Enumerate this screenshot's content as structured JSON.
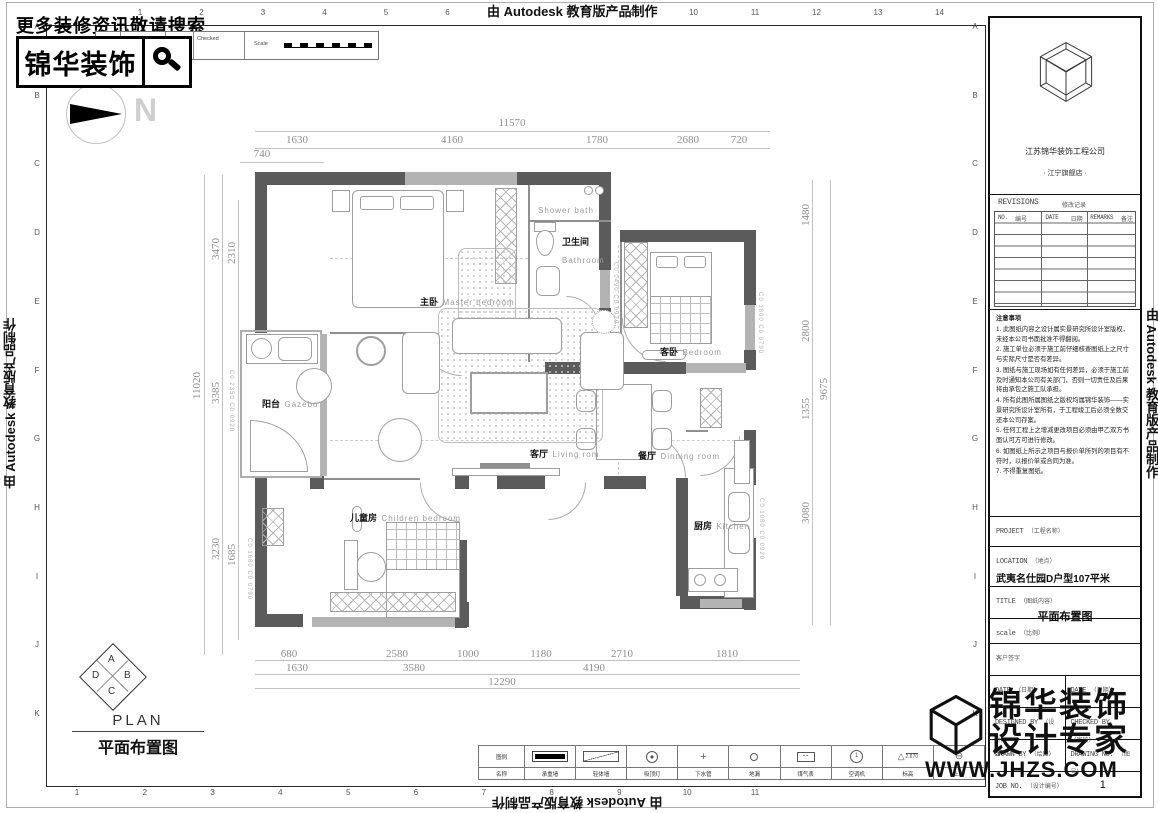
{
  "watermarks": {
    "autodesk": "由 Autodesk 教育版产品制作",
    "jhzs_line1": "锦华装饰",
    "jhzs_line2": "设计专家",
    "jhzs_url": "WWW.JHZS.COM"
  },
  "header": {
    "search_tip": "更多装修资讯敬请搜索",
    "brand": "锦华装饰",
    "north_label": "N",
    "rev_table": {
      "rev_no": "Rev/No",
      "revision_note": "Revision note",
      "signature": "Signature",
      "checked": "Checked",
      "scale_label": "Scale"
    }
  },
  "grid": {
    "top": [
      "1",
      "2",
      "3",
      "4",
      "5",
      "6",
      "7",
      "8",
      "9",
      "10",
      "11",
      "12",
      "13",
      "14"
    ],
    "bottom": [
      "1",
      "2",
      "3",
      "4",
      "5",
      "6",
      "7",
      "8",
      "9",
      "10",
      "11"
    ],
    "left": [
      "A",
      "B",
      "C",
      "D",
      "E",
      "F",
      "G",
      "H",
      "I",
      "J",
      "K"
    ],
    "right": [
      "A",
      "B",
      "C",
      "D",
      "E",
      "F",
      "G",
      "H",
      "I",
      "J",
      "K"
    ]
  },
  "plan": {
    "rooms": [
      {
        "cn": "主卧",
        "en": "Master bedroom"
      },
      {
        "cn": "",
        "en": "Shower bath"
      },
      {
        "cn": "卫生间",
        "en": "Bathroom"
      },
      {
        "cn": "客卧",
        "en": "Bedroom"
      },
      {
        "cn": "阳台",
        "en": "Gazebo"
      },
      {
        "cn": "客厅",
        "en": "Living rom"
      },
      {
        "cn": "餐厅",
        "en": "Dinning room"
      },
      {
        "cn": "儿童房",
        "en": "Children bedroom"
      },
      {
        "cn": "厨房",
        "en": "Kitchen"
      }
    ],
    "window_tags": [
      "C0 0490 C0 0920",
      "C0 1800 C0 0790",
      "C0 2350 C0 0920",
      "C0 1680 C0 0790",
      "C0 1080 C0 0920"
    ],
    "dims": {
      "top_total": "11570",
      "top": [
        "1630",
        "4160",
        "1780",
        "2680",
        "720"
      ],
      "top_sub": "740",
      "left_total": "11020",
      "left_outer": [
        "3470",
        "3385",
        "3230"
      ],
      "left_inner": [
        "2310",
        "1685"
      ],
      "right": [
        "1480",
        "2800",
        "1355",
        "3080"
      ],
      "right_total": "9675",
      "bottom_row1": [
        "680",
        "2580",
        "1000",
        "1180",
        "2710",
        "1810"
      ],
      "bottom_row2": [
        "1630",
        "3580",
        "4190"
      ],
      "bottom_total": "12290"
    }
  },
  "titleblock": {
    "company": "江苏锦华装饰工程公司",
    "store": "· 江宁旗舰店 ·",
    "revisions_title": "REVISIONS",
    "revisions_title_cn": "修改记录",
    "rev_no": "NO.",
    "rev_no_cn": "编号",
    "rev_date": "DATE",
    "rev_date_cn": "日期",
    "rev_remarks": "REMARKS",
    "rev_remarks_cn": "备注",
    "notes_title": "注意事项",
    "notes": [
      "1. 此图纸内容之设计属实景研究所设计室版权，未经本公司书面批准不得翻阅。",
      "2. 施工单位必须于施工前仔细核查图纸上之尺寸与实际尺寸是否有差异。",
      "3. 图纸与施工现场如有任何差异，必须于施工前及时通知本公司有关部门，否则一切责任及后果将由承包之施工队承担。",
      "4. 所有此图所属图纸之版权均属锦华装饰——实景研究所设计室所有，于工程竣工后必须全数交还本公司存案。",
      "5. 任何工程上之增减更改项目必须由甲乙双方书面认可方可进行修改。",
      "6. 如图纸上所示之项目与报价单所列的项目有不符时，以报价单或合同为准。",
      "7. 不得重复图纸。"
    ],
    "project_label": "PROJECT",
    "project_label_cn": "（工程名称）",
    "location_label": "LOCATION",
    "location_label_cn": "（地点）",
    "location_value": "武夷名仕园D户型107平米",
    "title_label": "TITLE",
    "title_label_cn": "（图纸内容）",
    "title_value": "平面布置图",
    "scale_label": "scale",
    "scale_label_cn": "（比例）",
    "client_sign": "客户签字",
    "date_label": "DATE",
    "date_label_cn": "（日期）",
    "designed_by": "DESIGNED BY",
    "designed_by_cn": "（设计）",
    "designer": "余",
    "checked_by": "CHECKED BY",
    "checked_by_cn": "（审核）",
    "drawn_by": "DRAWN BY",
    "drawn_by_cn": "（绘图）",
    "drawing_no": "DRAWING NO.",
    "drawing_no_cn": "（图号）",
    "drawing_no_value": "1",
    "job_no": "JOB NO.",
    "job_no_cn": "（设计编号）"
  },
  "legend": {
    "col0_top": "图例",
    "col0_bottom": "名称",
    "items": [
      {
        "name": "承重墙"
      },
      {
        "name": "轻体墙"
      },
      {
        "name": "吸顶灯"
      },
      {
        "name": "下水管"
      },
      {
        "name": "地漏"
      },
      {
        "name": "煤气表"
      },
      {
        "name": "空调机"
      },
      {
        "name": "标高",
        "value": "2.870"
      },
      {
        "name": "上水"
      }
    ]
  },
  "footer": {
    "plan_en": "PLAN",
    "plan_cn": "平面布置图",
    "dir_a": "A",
    "dir_b": "B",
    "dir_c": "C",
    "dir_d": "D"
  }
}
